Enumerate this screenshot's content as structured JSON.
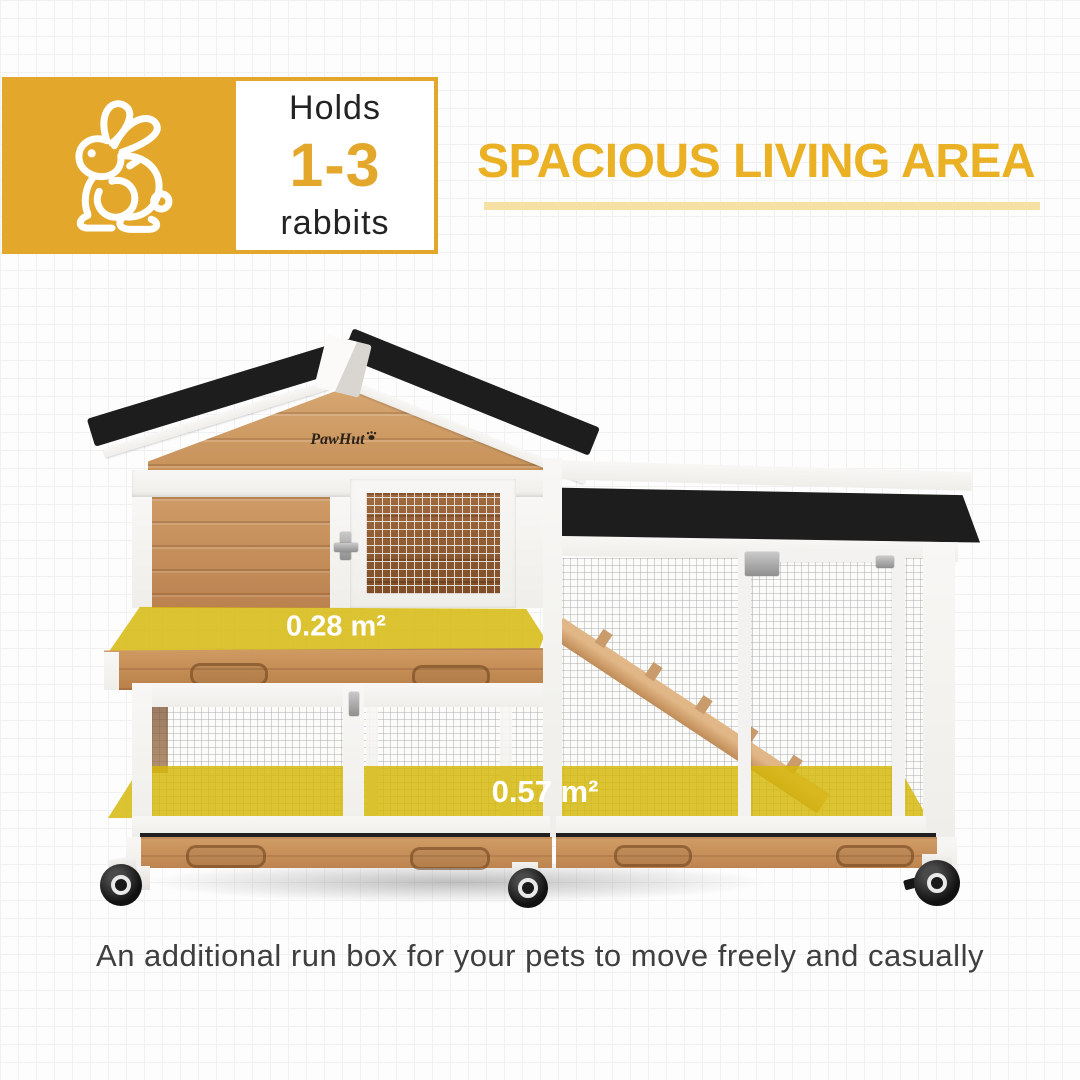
{
  "page": {
    "background_color": "#fdfdfd",
    "grid_line_color": "#f1f1f1"
  },
  "capacity_badge": {
    "icon": "rabbit-icon",
    "holds_label": "Holds",
    "range": "1-3",
    "animal_label": "rabbits",
    "accent_color": "#e3a82b"
  },
  "heading": {
    "title": "SPACIOUS LIVING AREA",
    "text_color": "#eab125",
    "underline_color": "#f5e1a4"
  },
  "product": {
    "brand": "PawHut",
    "area_labels": [
      "0.28 m²",
      "0.57 m²"
    ],
    "highlight_color": "#d5b70b",
    "roof_color": "#1d1d1d",
    "wood_color": "#c9915f",
    "frame_color": "#f5f4f2"
  },
  "caption": {
    "text": "An additional run box for your pets to move freely and casually",
    "text_color": "#3f3f3f"
  }
}
